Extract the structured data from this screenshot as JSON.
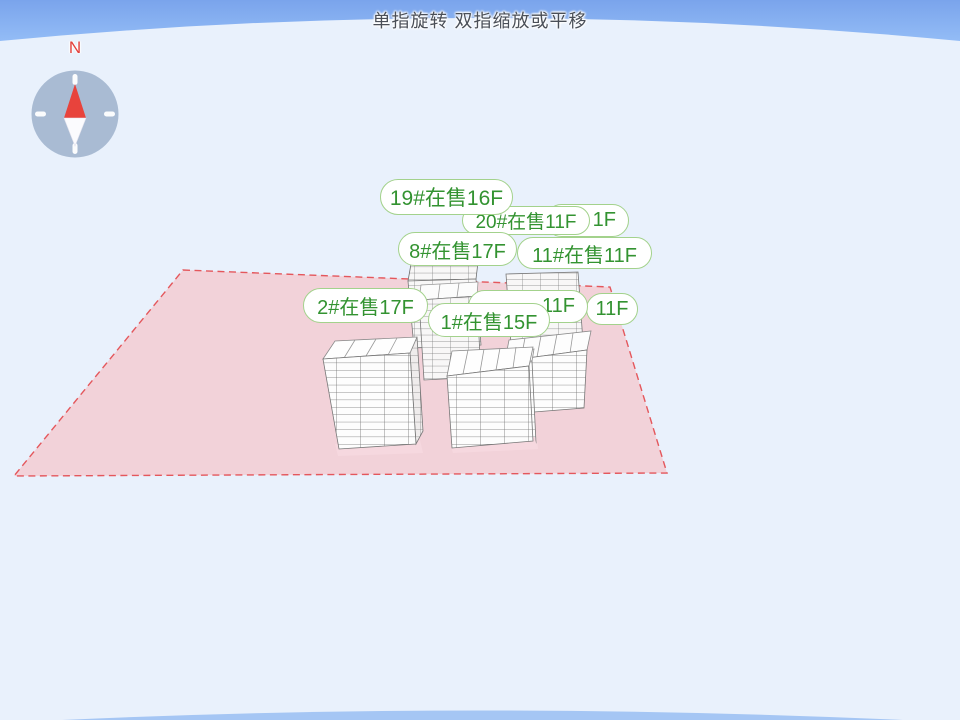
{
  "header": {
    "gesture_hint": "单指旋转 双指缩放或平移"
  },
  "compass": {
    "north_label": "N",
    "icon": "compass-rose"
  },
  "labels": [
    {
      "text": "19#在售16F"
    },
    {
      "text": "1F"
    },
    {
      "text": "20#在售11F"
    },
    {
      "text": "8#在售17F"
    },
    {
      "text": "11#在售11F"
    },
    {
      "text": "2#在售17F"
    },
    {
      "text": "11F"
    },
    {
      "text": "11F"
    },
    {
      "text": "1#在售15F"
    }
  ],
  "colors": {
    "sky": "#e9f1fc",
    "band_blue": "#86aff1",
    "site_fill": "#f2d2d9",
    "site_border": "#e4575c",
    "label_text": "#339331",
    "label_border": "#a3d28c",
    "north_red": "#e2403c"
  }
}
